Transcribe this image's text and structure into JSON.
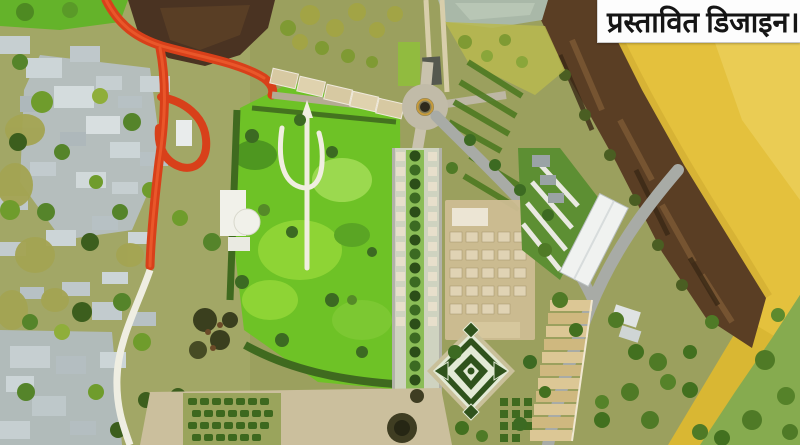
{
  "banner": {
    "text": "प्रस्तावित डिजाइन।",
    "background": "#fdfdfd",
    "text_color": "#151515"
  },
  "palette": {
    "beach_sand": "#e4c13d",
    "beach_highlight": "#efd567",
    "rock_cliff_brown": "#5a3e24",
    "pond_dark_brown": "#4a3322",
    "water_gray_green": "#a9b8a8",
    "park_green": "#6ec226",
    "park_light_green": "#8ed435",
    "road_red": "#d8401a",
    "building_gray": "#b6bfc2",
    "path_white": "#efeee2",
    "path_gray": "#a8aba6",
    "plaza_tan": "#cbbf9d",
    "promenade_strip": "#cfd3c0",
    "stall_tan": "#d7c9a2",
    "hedge_dark_green": "#3f6a1f",
    "ghat_step_tan": "#dcc795",
    "parterre_dark": "#2f521c",
    "parterre_light": "#e3ead6",
    "bottom_right_green": "#86ab4f"
  },
  "regions": {
    "beach": "sandy riverbank",
    "rock_cliff": "rocky escarpment",
    "park": "proposed landscaped park with trident path",
    "red_road": "approach road with loop",
    "promenade": "tree-lined market promenade",
    "parterre": "diamond pattern garden",
    "ghat_steps": "stepped ghat terraces",
    "pier": "walkway to water",
    "buildings": "existing settlement"
  }
}
